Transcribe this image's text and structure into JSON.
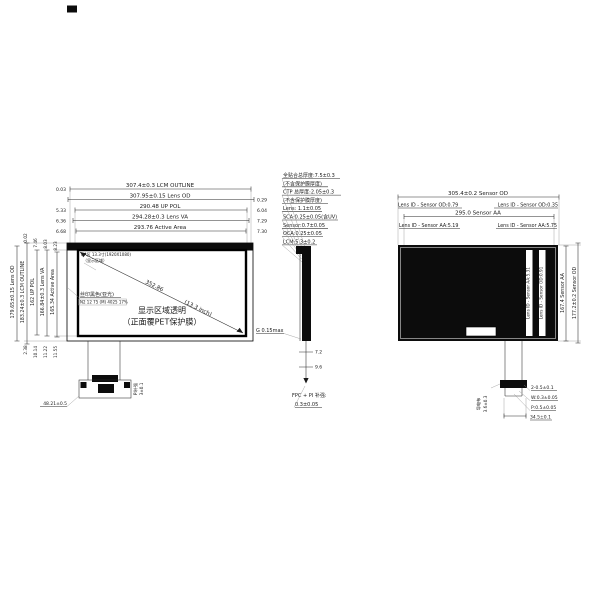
{
  "ink": "#1a1a1a",
  "front": {
    "top_dims": [
      {
        "text": "307.4±0.3 LCM OUTLINE",
        "side_l": "0.03",
        "side_r": ""
      },
      {
        "text": "307.95±0.15 Lens OD",
        "side_l": "",
        "side_r": "0.29"
      },
      {
        "text": "290.48 UP POL",
        "side_l": "5.33",
        "side_r": "6.04"
      },
      {
        "text": "294.28±0.3 Lens VA",
        "side_l": "6.36",
        "side_r": "7.29"
      },
      {
        "text": "293.76 Active Area",
        "side_l": "6.68",
        "side_r": "7.30"
      }
    ],
    "left_dims": [
      {
        "text": "179.65±0.15 Lens OD",
        "top": "",
        "bottom": ""
      },
      {
        "text": "183.24±0.3 LCM OUTLINE",
        "top": "0.02",
        "bottom": "2.38"
      },
      {
        "text": "162 UP POL",
        "top": "7.46",
        "bottom": "10.14"
      },
      {
        "text": "166.84±0.3 Lens VA",
        "top": "8.03",
        "bottom": "11.22"
      },
      {
        "text": "165.34 Active Area",
        "top": "8.23",
        "bottom": "11.55"
      }
    ],
    "aa_note": "AA区 13.3寸(1920X1080)",
    "aa_note2": "（显示区域）",
    "diag_dim": "352.86",
    "diag_inch": "(13.3 inch)",
    "silk_label": "丝印黑色(亚光)",
    "silk_spec": "N2 12 75 (M) 4025 17%",
    "center_line1": "显示区域透明",
    "center_line2": "（正面覆PET保护膜）",
    "fpc_offset": "48.21±0.5",
    "pi_label": "PI补强",
    "pi_dim": "3±0.1"
  },
  "side": {
    "notes": [
      "全贴合总厚度:7.5±0.3",
      "(不含保护膜厚度)",
      "CTP 总厚度:2.05±0.3",
      "(不含保护膜厚度)",
      "Lens: 1.1±0.05",
      "SCA:0.25±0.05(含UV)",
      "Sensor:0.7±0.05",
      "OCA:0.25±0.05",
      "LCM:5.3±0.2"
    ],
    "gap": "G 0.15max",
    "dim1": "7.2",
    "dim2": "9.6",
    "fpc_note1": "FPC + PI 补强:",
    "fpc_note2": "0.3±0.05"
  },
  "back": {
    "od_dim": "305.4±0.2 Sensor OD",
    "od_left": "Lens ID - Sensor OD:0.79",
    "od_right": "Lens ID - Sensor OD:0.35",
    "aa_dim": "295.0 Sensor AA",
    "aa_left": "Lens ID - Sensor AA:5.19",
    "aa_right": "Lens ID - Sensor AA:5.75",
    "v_inner_aa": "Lens ID - Sensor AA:5.31",
    "v_inner_od": "Lens ID - Sensor OD:0.91",
    "v_outer_aa": "167.4 Sensor AA",
    "v_outer_od": "177.2±0.2 Sensor OD",
    "cloth": "导电布",
    "cloth_dim": "3.6±0.3",
    "tail_dims": [
      "2-0.5±0.1",
      "W:0.3±0.05",
      "P:0.5±0.05",
      "34.5±0.1"
    ]
  }
}
